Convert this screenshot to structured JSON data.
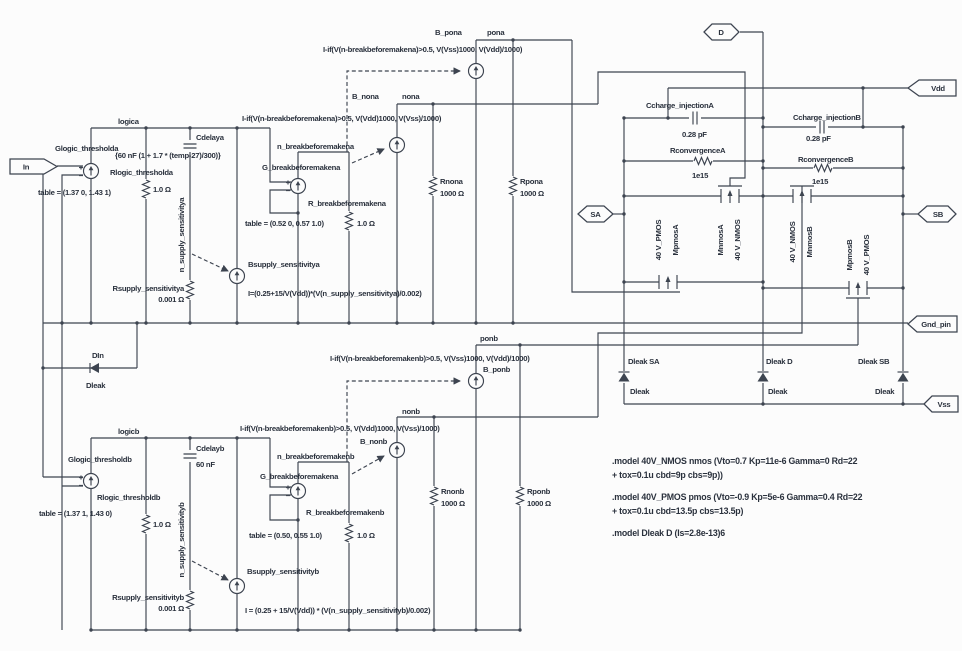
{
  "colors": {
    "wire": "#3d4450",
    "text": "#2a313d",
    "bg": "#fcfcfc"
  },
  "ports": {
    "in": "In",
    "d": "D",
    "vdd": "Vdd",
    "sa": "SA",
    "sb": "SB",
    "gnd_pin": "Gnd_pin",
    "vss": "Vss"
  },
  "input_clamp": {
    "name": "DIn",
    "model": "Dleak"
  },
  "section_a": {
    "net_logic": "logica",
    "glogic": {
      "name": "Glogic_thresholda",
      "table": "table = (1.37 0, 1.43 1)"
    },
    "rlogic": {
      "name": "Rlogic_thresholda",
      "value": "1.0 Ω"
    },
    "cdelay": {
      "name": "Cdelaya",
      "value": "{60 nF (1 + 1.7 * (temp-27)/300)}"
    },
    "n_supply": "n_supply_sensitivitya",
    "rsupply": {
      "name": "Rsupply_sensitivitya",
      "value": "0.001 Ω"
    },
    "bsupply": {
      "name": "Bsupply_sensitivitya",
      "formula": "I=(0.25+15/V(Vdd))*(V(n_supply_sensitivitya)/0.002)"
    },
    "n_break": "n_breakbeforemakena",
    "gbreak": {
      "name": "G_breakbeforemakena",
      "table": "table = (0.52 0, 0.57 1.0)"
    },
    "rbreak": {
      "name": "R_breakbeforemakena",
      "value": "1.0 Ω"
    },
    "bnon": {
      "name": "B_nona",
      "net": "nona",
      "formula": "I-if(V(n-breakbeforemakena)>0.5, V(Vdd)1000, V(Vss)/1000)"
    },
    "bpon": {
      "name": "B_pona",
      "net": "pona",
      "formula": "I-if(V(n-breakbeforemakena)>0.5, V(Vss)1000, V(Vdd)/1000)"
    },
    "rnon": {
      "name": "Rnona",
      "value": "1000 Ω"
    },
    "rpon": {
      "name": "Rpona",
      "value": "1000 Ω"
    }
  },
  "section_b": {
    "net_logic": "logicb",
    "glogic": {
      "name": "Glogic_thresholdb",
      "table": "table = (1.37 1, 1.43 0)"
    },
    "rlogic": {
      "name": "Rlogic_thresholdb",
      "value": "1.0 Ω"
    },
    "cdelay": {
      "name": "Cdelayb",
      "value": "60 nF"
    },
    "n_supply": "n_supply_sensitivityb",
    "rsupply": {
      "name": "Rsupply_sensitivityb",
      "value": "0.001 Ω"
    },
    "bsupply": {
      "name": "Bsupply_sensitivityb",
      "formula": "I = (0.25 + 15/V(Vdd)) * (V(n_supply_sensitivityb)/0.002)"
    },
    "n_break": "n_breakbeforemakenb",
    "gbreak": {
      "name": "G_breakbeforemakena",
      "table": "table = (0.50, 0.55 1.0)"
    },
    "rbreak": {
      "name": "R_breakbeforemakenb",
      "value": "1.0 Ω"
    },
    "bnon": {
      "name": "B_nonb",
      "net": "nonb",
      "formula": "I-if(V(n-breakbeforemakenb)>0.5, V(Vdd)1000, V(Vss)/1000)"
    },
    "bpon": {
      "name": "B_ponb",
      "net": "ponb",
      "formula": "I-if(V(n-breakbeforemakenb)>0.5, V(Vss)1000, V(Vdd)/1000)"
    },
    "rnon": {
      "name": "Rnonb",
      "value": "1000 Ω"
    },
    "rpon": {
      "name": "Rponb",
      "value": "1000 Ω"
    }
  },
  "output_stage": {
    "cc_a": {
      "name": "Ccharge_injectionA",
      "value": "0.28 pF"
    },
    "rc_a": {
      "name": "RconvergenceA",
      "value": "1e15"
    },
    "cc_b": {
      "name": "Ccharge_injectionB",
      "value": "0.28 pF"
    },
    "rc_b": {
      "name": "RconvergenceB",
      "value": "1e15"
    },
    "mpmos_a": "MpmosA",
    "mnmos_a": "MnmosA",
    "mnmos_b": "MnmosB",
    "mpmos_b": "MpmosB",
    "pmos_type": "40 V_PMOS",
    "nmos_type": "40 V_NMOS",
    "dleak_sa": {
      "name": "Dleak SA",
      "model": "Dleak"
    },
    "dleak_d": {
      "name": "Dleak D",
      "model": "Dleak"
    },
    "dleak_sb": {
      "name": "Dleak SB",
      "model": "Dleak"
    }
  },
  "models": {
    "nmos_l1": ".model 40V_NMOS nmos (Vto=0.7 Kp=11e-6 Gamma=0 Rd=22",
    "nmos_l2": "+ tox=0.1u cbd=9p cbs=9p))",
    "pmos_l1": ".model 40V_PMOS pmos (Vto=-0.9 Kp=5e-6 Gamma=0.4 Rd=22",
    "pmos_l2": "+ tox=0.1u cbd=13.5p cbs=13.5p)",
    "dleak_l1": ".model Dleak D (Is=2.8e-13)6"
  }
}
